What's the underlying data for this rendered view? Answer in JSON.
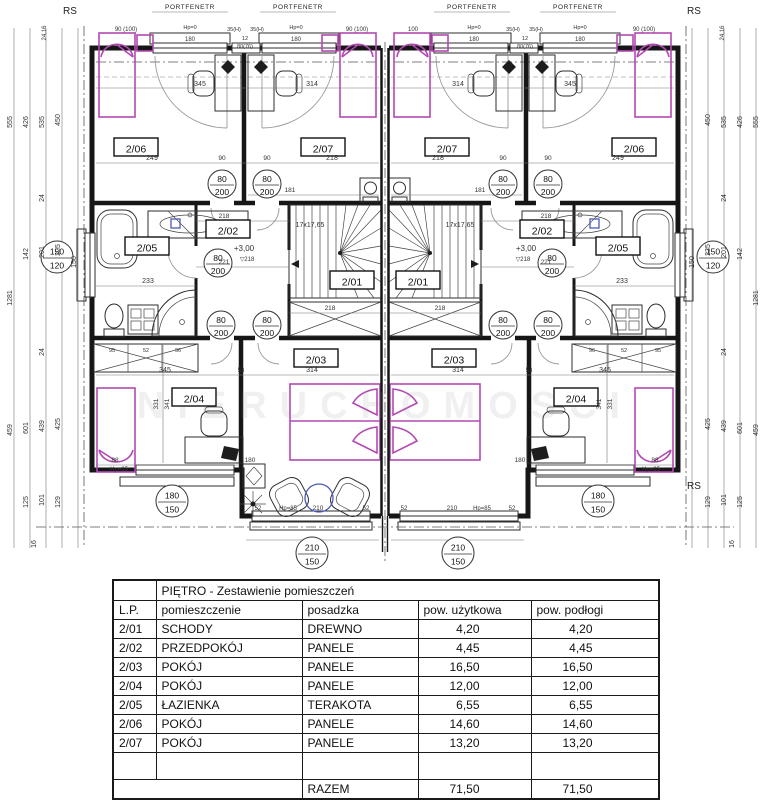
{
  "colors": {
    "wall": "#161616",
    "furniture_accent": "#b348b3",
    "blue_accent": "#4a5ab8",
    "line": "#2e2e2e"
  },
  "plan": {
    "watermark": "NIERUCHOMOSCI",
    "rs_labels": [
      {
        "t": "RS",
        "x": 70,
        "y": 14
      },
      {
        "t": "RS",
        "x": 694,
        "y": 14
      },
      {
        "t": "RS",
        "x": 694,
        "y": 489
      }
    ],
    "portfenetr": {
      "label": "PORTFENETR",
      "y": 9,
      "positions": [
        190,
        298,
        472,
        578
      ]
    },
    "room_labels": [
      {
        "t": "2/06",
        "x": 136,
        "y": 150
      },
      {
        "t": "2/07",
        "x": 323,
        "y": 150
      },
      {
        "t": "2/02",
        "x": 228,
        "y": 232
      },
      {
        "t": "2/05",
        "x": 147,
        "y": 249
      },
      {
        "t": "2/01",
        "x": 352,
        "y": 283
      },
      {
        "t": "2/03",
        "x": 316,
        "y": 361
      },
      {
        "t": "2/04",
        "x": 194,
        "y": 400
      },
      {
        "t": "2/07",
        "x": 447,
        "y": 150
      },
      {
        "t": "2/06",
        "x": 634,
        "y": 150
      },
      {
        "t": "2/02",
        "x": 542,
        "y": 232
      },
      {
        "t": "2/05",
        "x": 618,
        "y": 249
      },
      {
        "t": "2/01",
        "x": 418,
        "y": 283
      },
      {
        "t": "2/03",
        "x": 454,
        "y": 361
      },
      {
        "t": "2/04",
        "x": 576,
        "y": 400
      }
    ],
    "door_markers": [
      {
        "top": "80",
        "bottom": "200",
        "x": 222,
        "y": 184
      },
      {
        "top": "80",
        "bottom": "200",
        "x": 267,
        "y": 184
      },
      {
        "top": "80",
        "bottom": "200",
        "x": 503,
        "y": 184
      },
      {
        "top": "80",
        "bottom": "200",
        "x": 548,
        "y": 184
      },
      {
        "top": "80",
        "bottom": "200",
        "x": 218,
        "y": 263
      },
      {
        "top": "80",
        "bottom": "200",
        "x": 552,
        "y": 263
      },
      {
        "top": "80",
        "bottom": "200",
        "x": 221,
        "y": 325
      },
      {
        "top": "80",
        "bottom": "200",
        "x": 267,
        "y": 325
      },
      {
        "top": "80",
        "bottom": "200",
        "x": 503,
        "y": 325
      },
      {
        "top": "80",
        "bottom": "200",
        "x": 548,
        "y": 325
      }
    ],
    "window_markers": [
      {
        "top": "150",
        "bottom": "120",
        "x": 57,
        "y": 257
      },
      {
        "top": "150",
        "bottom": "120",
        "x": 713,
        "y": 257
      },
      {
        "top": "180",
        "bottom": "150",
        "x": 172,
        "y": 501
      },
      {
        "top": "180",
        "bottom": "150",
        "x": 598,
        "y": 501
      },
      {
        "top": "210",
        "bottom": "150",
        "x": 312,
        "y": 553
      },
      {
        "top": "210",
        "bottom": "150",
        "x": 458,
        "y": 553
      }
    ],
    "dim_texts": [
      [
        "345",
        200,
        86,
        7
      ],
      [
        "314",
        312,
        86,
        7
      ],
      [
        "314",
        458,
        86,
        7
      ],
      [
        "345",
        570,
        86,
        7
      ],
      [
        "249",
        152,
        160,
        7
      ],
      [
        "90",
        222,
        160,
        6.5
      ],
      [
        "90",
        267,
        160,
        6.5
      ],
      [
        "218",
        332,
        160,
        7
      ],
      [
        "218",
        438,
        160,
        7
      ],
      [
        "90",
        503,
        160,
        6.5
      ],
      [
        "90",
        548,
        160,
        6.5
      ],
      [
        "249",
        618,
        160,
        7
      ],
      [
        "181",
        290,
        192,
        6.5
      ],
      [
        "181",
        480,
        192,
        6.5
      ],
      [
        "218",
        224,
        218,
        6.5
      ],
      [
        "218",
        546,
        218,
        6.5
      ],
      [
        "221",
        224,
        264,
        6.5
      ],
      [
        "221",
        546,
        264,
        6.5
      ],
      [
        "233",
        148,
        283,
        7
      ],
      [
        "233",
        622,
        283,
        7
      ],
      [
        "218",
        330,
        310,
        6.5
      ],
      [
        "218",
        440,
        310,
        6.5
      ],
      [
        "345",
        165,
        372,
        7
      ],
      [
        "53",
        241,
        372,
        6
      ],
      [
        "314",
        312,
        372,
        7
      ],
      [
        "314",
        458,
        372,
        7
      ],
      [
        "53",
        529,
        372,
        6
      ],
      [
        "345",
        605,
        372,
        7
      ],
      [
        "331",
        158,
        404,
        6.5,
        "r"
      ],
      [
        "341",
        169,
        404,
        6.5,
        "r"
      ],
      [
        "341",
        601,
        404,
        6.5,
        "r"
      ],
      [
        "331",
        612,
        404,
        6.5,
        "r"
      ],
      [
        "180",
        250,
        462,
        6.5
      ],
      [
        "180",
        520,
        462,
        6.5
      ],
      [
        "88",
        115,
        462,
        6.5
      ],
      [
        "88",
        655,
        462,
        6.5
      ],
      [
        "Hp=85",
        119,
        471,
        6
      ],
      [
        "Hp=85",
        651,
        471,
        6
      ],
      [
        "52",
        258,
        510,
        6
      ],
      [
        "Hp=85",
        288,
        510,
        6
      ],
      [
        "210",
        318,
        510,
        6.5
      ],
      [
        "52",
        366,
        510,
        6
      ],
      [
        "52",
        404,
        510,
        6
      ],
      [
        "210",
        452,
        510,
        6.5
      ],
      [
        "Hp=85",
        482,
        510,
        6
      ],
      [
        "52",
        512,
        510,
        6
      ],
      [
        "35(H)",
        234,
        31,
        5.5
      ],
      [
        "35(H)",
        257,
        31,
        5.5
      ],
      [
        "35(H)",
        513,
        31,
        5.5
      ],
      [
        "35(H)",
        536,
        31,
        5.5
      ],
      [
        "12",
        245,
        40,
        5.5
      ],
      [
        "80(76)",
        245,
        48,
        5.5
      ],
      [
        "12",
        525,
        40,
        5.5
      ],
      [
        "80(76)",
        525,
        48,
        5.5
      ],
      [
        "Hp=0",
        190,
        29,
        5.5
      ],
      [
        "180",
        190,
        41,
        6
      ],
      [
        "Hp=0",
        296,
        29,
        5.5
      ],
      [
        "180",
        296,
        41,
        6
      ],
      [
        "Hp=0",
        474,
        29,
        5.5
      ],
      [
        "180",
        474,
        41,
        6
      ],
      [
        "Hp=0",
        580,
        29,
        5.5
      ],
      [
        "180",
        580,
        41,
        6
      ],
      [
        "+3,00",
        244,
        251,
        8
      ],
      [
        "+3,00",
        526,
        251,
        8
      ],
      [
        "▽218",
        247,
        261,
        6
      ],
      [
        "▽218",
        523,
        261,
        6
      ],
      [
        "17x17,65",
        310,
        227,
        7
      ],
      [
        "17x17,65",
        460,
        227,
        7
      ],
      [
        "90 (100)",
        126,
        31,
        6,
        "m"
      ],
      [
        "90 (100)",
        357,
        31,
        6,
        "m"
      ],
      [
        "100",
        413,
        31,
        6,
        "m"
      ],
      [
        "90 (100)",
        644,
        31,
        6,
        "m"
      ],
      [
        "95",
        112,
        352,
        5.5
      ],
      [
        "52",
        146,
        352,
        5.5
      ],
      [
        "96",
        178,
        352,
        5.5
      ],
      [
        "96",
        592,
        352,
        5.5
      ],
      [
        "52",
        624,
        352,
        5.5
      ],
      [
        "95",
        658,
        352,
        5.5
      ],
      [
        "24,16",
        46,
        33,
        6,
        "r"
      ],
      [
        "24,16",
        724,
        33,
        6,
        "r"
      ]
    ],
    "outer_dims_left": [
      [
        "555",
        12,
        122
      ],
      [
        "426",
        28,
        122
      ],
      [
        "535",
        44,
        122
      ],
      [
        "450",
        60,
        120
      ],
      [
        "1281",
        12,
        298
      ],
      [
        "142",
        28,
        254
      ],
      [
        "201",
        44,
        252
      ],
      [
        "225",
        60,
        250
      ],
      [
        "150",
        76,
        262
      ],
      [
        "24",
        44,
        198
      ],
      [
        "24",
        44,
        352
      ],
      [
        "459",
        12,
        430
      ],
      [
        "601",
        28,
        428
      ],
      [
        "439",
        44,
        426
      ],
      [
        "425",
        60,
        424
      ],
      [
        "125",
        28,
        502
      ],
      [
        "101",
        44,
        500
      ],
      [
        "129",
        60,
        502
      ],
      [
        "16",
        36,
        544
      ]
    ],
    "outer_dims_right": [
      [
        "555",
        758,
        122
      ],
      [
        "426",
        742,
        122
      ],
      [
        "535",
        726,
        122
      ],
      [
        "450",
        710,
        120
      ],
      [
        "1281",
        758,
        298
      ],
      [
        "142",
        742,
        254
      ],
      [
        "201",
        726,
        252
      ],
      [
        "225",
        710,
        250
      ],
      [
        "150",
        694,
        262
      ],
      [
        "24",
        726,
        198
      ],
      [
        "24",
        726,
        352
      ],
      [
        "459",
        758,
        430
      ],
      [
        "601",
        742,
        428
      ],
      [
        "439",
        726,
        426
      ],
      [
        "425",
        710,
        424
      ],
      [
        "125",
        742,
        502
      ],
      [
        "101",
        726,
        500
      ],
      [
        "129",
        710,
        502
      ],
      [
        "16",
        734,
        544
      ]
    ]
  },
  "table": {
    "title": "PIĘTRO - Zestawienie pomieszczeń",
    "columns": [
      "L.P.",
      "pomieszczenie",
      "posadzka",
      "pow. użytkowa",
      "pow. podłogi"
    ],
    "rows": [
      [
        "2/01",
        "SCHODY",
        "DREWNO",
        "4,20",
        "4,20"
      ],
      [
        "2/02",
        "PRZEDPOKÓJ",
        "PANELE",
        "4,45",
        "4,45"
      ],
      [
        "2/03",
        "POKÓJ",
        "PANELE",
        "16,50",
        "16,50"
      ],
      [
        "2/04",
        "POKÓJ",
        "PANELE",
        "12,00",
        "12,00"
      ],
      [
        "2/05",
        "ŁAZIENKA",
        "TERAKOTA",
        "6,55",
        "6,55"
      ],
      [
        "2/06",
        "POKÓJ",
        "PANELE",
        "14,60",
        "14,60"
      ],
      [
        "2/07",
        "POKÓJ",
        "PANELE",
        "13,20",
        "13,20"
      ]
    ],
    "total_label": "RAZEM",
    "total_util": "71,50",
    "total_floor": "71,50"
  }
}
